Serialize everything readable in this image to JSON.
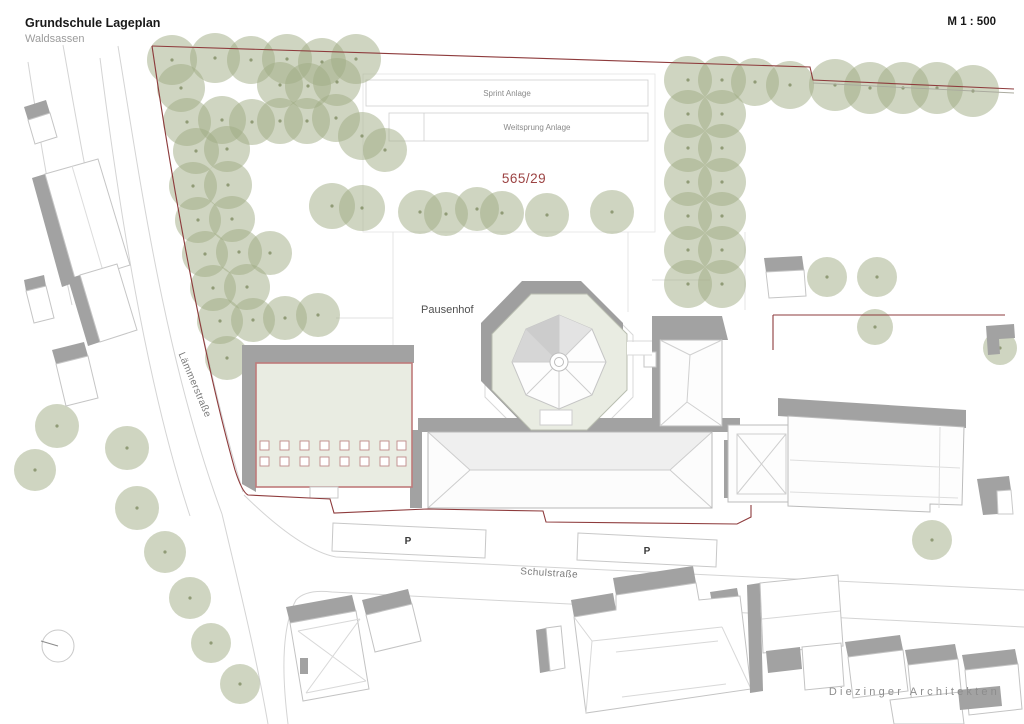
{
  "header": {
    "title": "Grundschule Lageplan",
    "subtitle": "Waldsassen",
    "scale": "M 1 : 500"
  },
  "footer": {
    "firm": "Diezinger Architekten"
  },
  "plan": {
    "labels": {
      "sprint": "Sprint Anlage",
      "long_jump": "Weitsprung Anlage",
      "parcel": "565/29",
      "courtyard": "Pausenhof",
      "street_west": "Lämmerstraße",
      "street_south": "Schulstraße",
      "parking1": "P",
      "parking2": "P"
    },
    "colors": {
      "tree": "#9fab83",
      "tree_dot": "#7f8c63",
      "boundary": "#8e3b3c",
      "highlight_outline": "#bf7b7b",
      "parcel_text": "#9c4343",
      "shadow": "#a2a2a2",
      "octagon_fill": "#e9ece2"
    },
    "trees": [
      [
        172,
        60,
        25
      ],
      [
        215,
        58,
        25
      ],
      [
        251,
        60,
        24
      ],
      [
        287,
        59,
        25
      ],
      [
        322,
        62,
        24
      ],
      [
        356,
        59,
        25
      ],
      [
        181,
        88,
        24
      ],
      [
        280,
        85,
        23
      ],
      [
        308,
        86,
        23
      ],
      [
        337,
        82,
        24
      ],
      [
        187,
        122,
        24
      ],
      [
        222,
        120,
        24
      ],
      [
        252,
        122,
        23
      ],
      [
        280,
        121,
        23
      ],
      [
        307,
        121,
        23
      ],
      [
        336,
        118,
        24
      ],
      [
        196,
        151,
        23
      ],
      [
        227,
        149,
        23
      ],
      [
        362,
        136,
        24
      ],
      [
        385,
        150,
        22
      ],
      [
        193,
        186,
        24
      ],
      [
        228,
        185,
        24
      ],
      [
        198,
        220,
        23
      ],
      [
        232,
        219,
        23
      ],
      [
        332,
        206,
        23
      ],
      [
        362,
        208,
        23
      ],
      [
        205,
        254,
        23
      ],
      [
        239,
        252,
        23
      ],
      [
        270,
        253,
        22
      ],
      [
        213,
        288,
        23
      ],
      [
        247,
        287,
        23
      ],
      [
        220,
        321,
        23
      ],
      [
        253,
        320,
        22
      ],
      [
        285,
        318,
        22
      ],
      [
        318,
        315,
        22
      ],
      [
        227,
        358,
        22
      ],
      [
        420,
        212,
        22
      ],
      [
        446,
        214,
        22
      ],
      [
        477,
        209,
        22
      ],
      [
        502,
        213,
        22
      ],
      [
        547,
        215,
        22
      ],
      [
        612,
        212,
        22
      ],
      [
        688,
        80,
        24
      ],
      [
        688,
        114,
        24
      ],
      [
        688,
        148,
        24
      ],
      [
        688,
        182,
        24
      ],
      [
        688,
        216,
        24
      ],
      [
        688,
        250,
        24
      ],
      [
        688,
        284,
        24
      ],
      [
        722,
        80,
        24
      ],
      [
        722,
        114,
        24
      ],
      [
        722,
        148,
        24
      ],
      [
        722,
        182,
        24
      ],
      [
        722,
        216,
        24
      ],
      [
        722,
        250,
        24
      ],
      [
        722,
        284,
        24
      ],
      [
        755,
        82,
        24
      ],
      [
        790,
        85,
        24
      ],
      [
        835,
        85,
        26
      ],
      [
        870,
        88,
        26
      ],
      [
        903,
        88,
        26
      ],
      [
        937,
        88,
        26
      ],
      [
        973,
        91,
        26
      ],
      [
        827,
        277,
        20
      ],
      [
        877,
        277,
        20
      ],
      [
        875,
        327,
        18
      ],
      [
        1000,
        348,
        17
      ],
      [
        932,
        540,
        20
      ],
      [
        57,
        426,
        22
      ],
      [
        35,
        470,
        21
      ],
      [
        127,
        448,
        22
      ],
      [
        137,
        508,
        22
      ],
      [
        165,
        552,
        21
      ],
      [
        190,
        598,
        21
      ],
      [
        211,
        643,
        20
      ],
      [
        240,
        684,
        20
      ]
    ]
  }
}
